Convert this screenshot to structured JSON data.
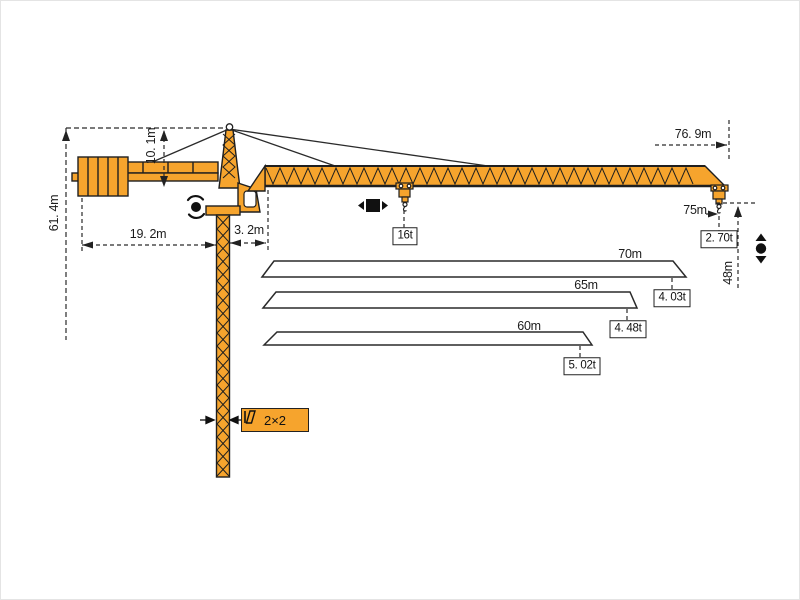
{
  "diagram_title": "tower crane working range and load diagram",
  "colors": {
    "crane_orange": "#F6A42D",
    "outline_dark": "#222222",
    "dimension_line": "#2a2a2a"
  },
  "dimensions": {
    "total_height": "61. 4m",
    "tower_peak_height": "10. 1m",
    "counter_jib_radius": "19. 2m",
    "jib_root_offset": "3. 2m",
    "jib_span": "76. 9m",
    "max_radius": "75m",
    "hook_height": "48m"
  },
  "loads": {
    "max_hoist_load": "16t",
    "tip_load_max_radius": "2. 70t"
  },
  "jib_options": [
    {
      "length": "70m",
      "tip_load": "4. 03t"
    },
    {
      "length": "65m",
      "tip_load": "4. 48t"
    },
    {
      "length": "60m",
      "tip_load": "5. 02t"
    }
  ],
  "mast": {
    "section": "2×2"
  }
}
